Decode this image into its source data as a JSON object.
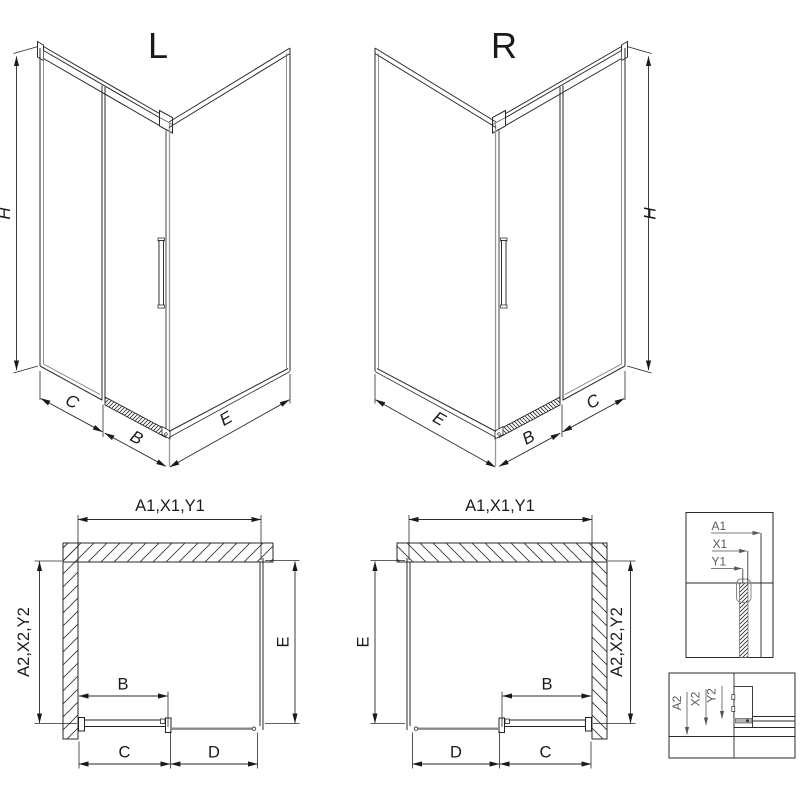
{
  "drawing": {
    "background": "#ffffff",
    "line_color": "#2a2a2a",
    "dim_color": "#1a1a1a",
    "detail_label_color": "#5a5a5a"
  },
  "iso_left": {
    "title": "L",
    "dims": {
      "height": "H",
      "c": "C",
      "b": "B",
      "e": "E"
    }
  },
  "iso_right": {
    "title": "R",
    "dims": {
      "height": "H",
      "c": "C",
      "b": "B",
      "e": "E"
    }
  },
  "plan_left": {
    "dim_width_top": "A1,X1,Y1",
    "dim_depth_left": "A2,X2,Y2",
    "dim_depth_right": "E",
    "dim_door": "B",
    "dim_c": "C",
    "dim_d": "D"
  },
  "plan_right": {
    "dim_width_top": "A1,X1,Y1",
    "dim_depth_left": "E",
    "dim_depth_right": "A2,X2,Y2",
    "dim_door": "B",
    "dim_d": "D",
    "dim_c": "C"
  },
  "detail_width_section": {
    "labels": [
      "A1",
      "X1",
      "Y1"
    ]
  },
  "detail_floor_section": {
    "labels": [
      "A2",
      "X2",
      "Y2"
    ]
  }
}
